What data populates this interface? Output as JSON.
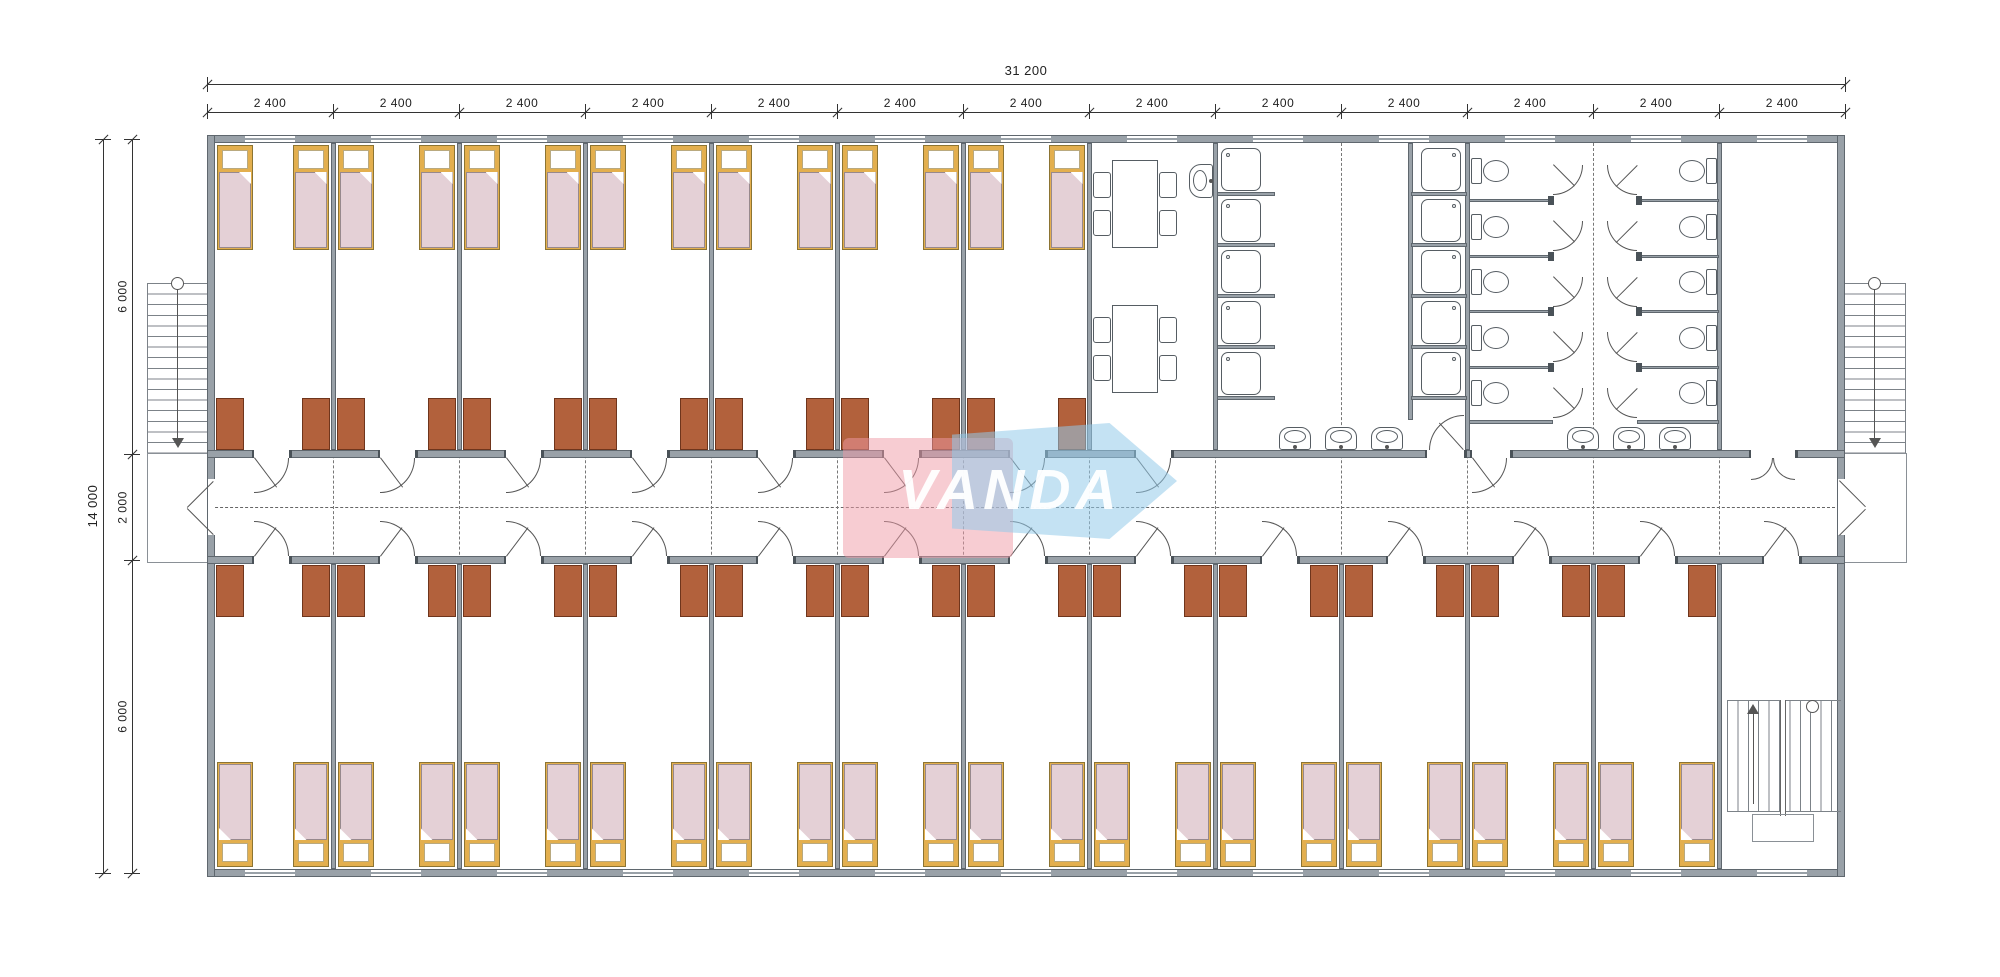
{
  "logo": {
    "text": "VANDA",
    "pink": "rgba(240,153,165,0.50)",
    "blue": "rgba(148,202,233,0.55)",
    "text_color": "rgba(255,255,255,0.95)"
  },
  "dimensions": {
    "top_total": "31 200",
    "top_modules": [
      "2 400",
      "2 400",
      "2 400",
      "2 400",
      "2 400",
      "2 400",
      "2 400",
      "2 400",
      "2 400",
      "2 400",
      "2 400",
      "2 400",
      "2 400"
    ],
    "left_total": "14 000",
    "left_segments": [
      "6 000",
      "2 000",
      "6 000"
    ]
  },
  "layout": {
    "modules": 13,
    "top_rooms": 7,
    "bottom_rooms": 12,
    "beds_per_room": 2,
    "wardrobes_per_room": 2,
    "dining_tables": 2,
    "chairs_per_table": 4,
    "shower_columns": 2,
    "shower_stalls_per_column": 5,
    "toilet_columns": 2,
    "toilet_stalls_per_column": 5,
    "wash_basins_wall": 6,
    "wash_basin_dining": 1,
    "external_stairs": 2,
    "internal_stairs": 1
  },
  "colors": {
    "wall": "#99a1a8",
    "wall_edge": "#5f676e",
    "bed_frame": "#e3af4e",
    "bed_frame_edge": "#8c7433",
    "blanket": "#e4d0d6",
    "blanket_edge": "#97898d",
    "wardrobe": "#b2613c",
    "wardrobe_edge": "#6f351c",
    "fixture_line": "#565d63",
    "stair_line": "#7c8288",
    "dim_line": "#333333",
    "dash": "#777777"
  }
}
